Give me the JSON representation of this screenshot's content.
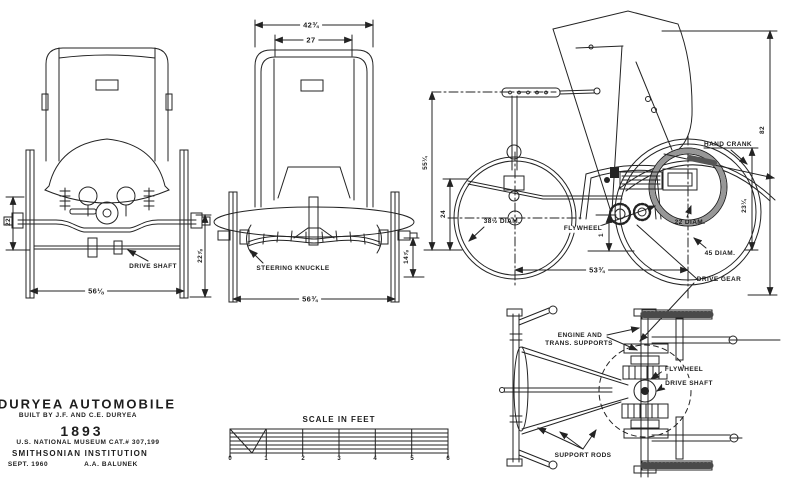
{
  "drawing": {
    "paper_color": "#ffffff",
    "ink_color": "#232323",
    "title_block": {
      "title": "DURYEA AUTOMOBILE",
      "built_by": "BUILT BY J.F. AND C.E. DURYEA",
      "year": "1893",
      "catalog": "U.S. NATIONAL MUSEUM CAT.# 307,199",
      "institution": "SMITHSONIAN INSTITUTION",
      "date": "SEPT. 1960",
      "drafter": "A.A. BALUNEK"
    },
    "scale_bar": {
      "title": "SCALE IN FEET",
      "ticks": [
        "0",
        "1",
        "2",
        "3",
        "4",
        "5",
        "6"
      ]
    },
    "rear_view": {
      "dims": {
        "axle_height_left": "22",
        "wheel_height_right": "22⅞",
        "track_width": "56⅛"
      },
      "labels": {
        "drive_shaft": "DRIVE SHAFT"
      }
    },
    "front_view": {
      "dims": {
        "body_width": "42¾",
        "seat_width": "27",
        "axle_height": "14⅞",
        "track_width": "56¾"
      },
      "labels": {
        "steering_knuckle": "STEERING KNUCKLE"
      }
    },
    "side_view": {
      "dims": {
        "overall_height": "82",
        "body_height": "55¼",
        "front_hub_height": "24",
        "rear_hub_height": "23¼",
        "gear_drop": "13",
        "wheelbase": "53¾",
        "front_wheel": "38½ DIAM.",
        "flywheel": "22 DIAM.",
        "rear_wheel": "45 DIAM."
      },
      "labels": {
        "hand_crank": "HAND CRANK",
        "flywheel": "FLYWHEEL",
        "drive_gear": "DRIVE GEAR"
      }
    },
    "plan_view": {
      "labels": {
        "engine_supports_line1": "ENGINE AND",
        "engine_supports_line2": "TRANS. SUPPORTS",
        "flywheel": "FLYWHEEL",
        "drive_shaft": "DRIVE SHAFT",
        "support_rods": "SUPPORT RODS"
      }
    }
  }
}
